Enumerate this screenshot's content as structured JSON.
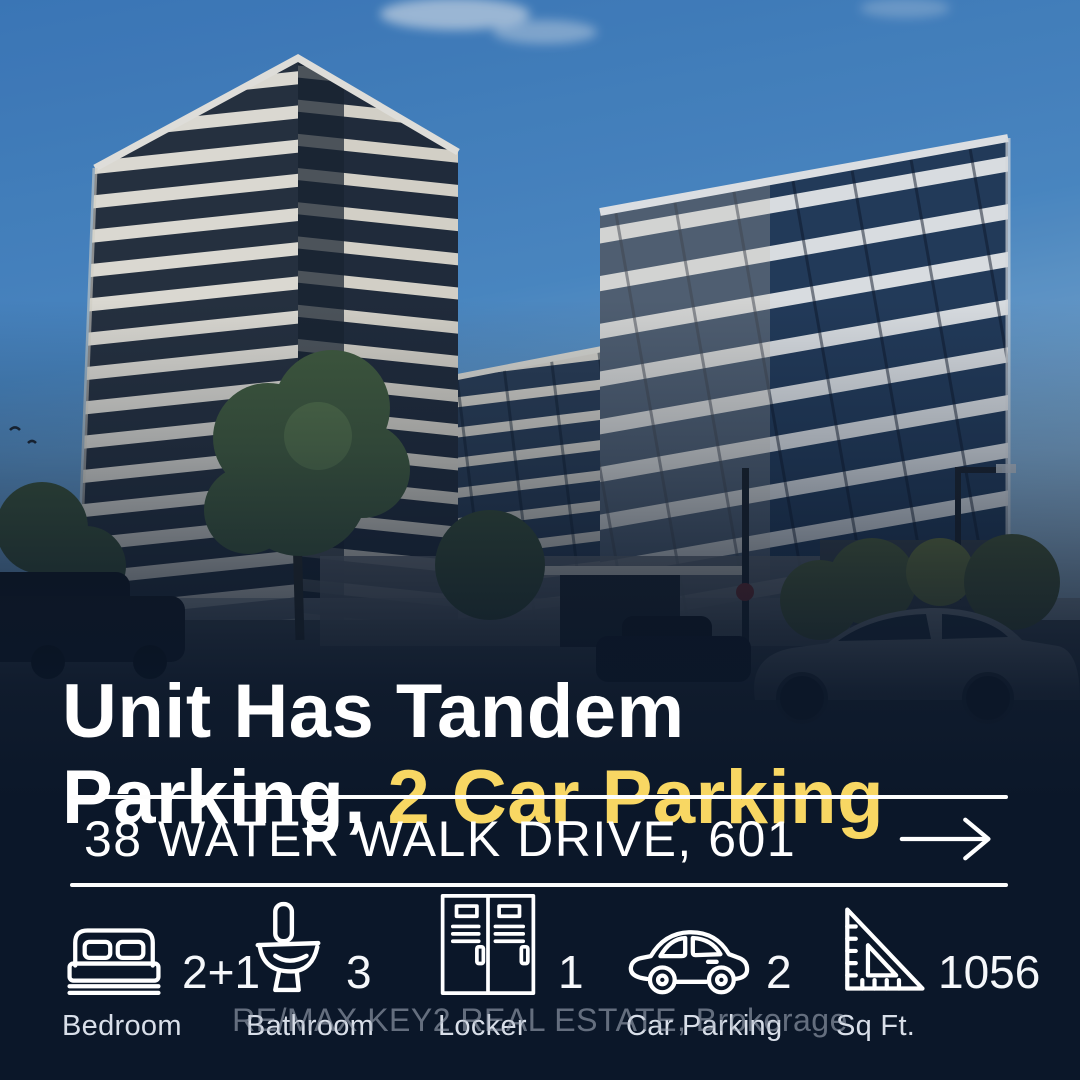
{
  "headline": {
    "line1": "Unit Has Tandem",
    "line2_prefix": "Parking, ",
    "line2_highlight": "2 Car Parking"
  },
  "address": {
    "label": "38 WATER WALK DRIVE, 601",
    "arrow_icon": "arrow-right-icon"
  },
  "stats": [
    {
      "icon": "bed-icon",
      "value": "2+1",
      "label": "Bedroom"
    },
    {
      "icon": "toilet-icon",
      "value": "3",
      "label": "Bathroom"
    },
    {
      "icon": "locker-icon",
      "value": "1",
      "label": "Locker"
    },
    {
      "icon": "car-icon",
      "value": "2",
      "label": "Car Parking"
    },
    {
      "icon": "ruler-icon",
      "value": "1056",
      "label": "Sq Ft."
    }
  ],
  "watermark": {
    "text": "RE/MAX KEY2 REAL ESTATE, Brokerage"
  },
  "photo": {
    "description": "Two modern condo towers with white balcony bands against a blue sky, street with trees and cars below"
  },
  "colors": {
    "background_navy": "#0B1729",
    "highlight_yellow": "#F8D763",
    "text_white": "#FFFFFF",
    "label_gray": "#D9DFE9"
  }
}
